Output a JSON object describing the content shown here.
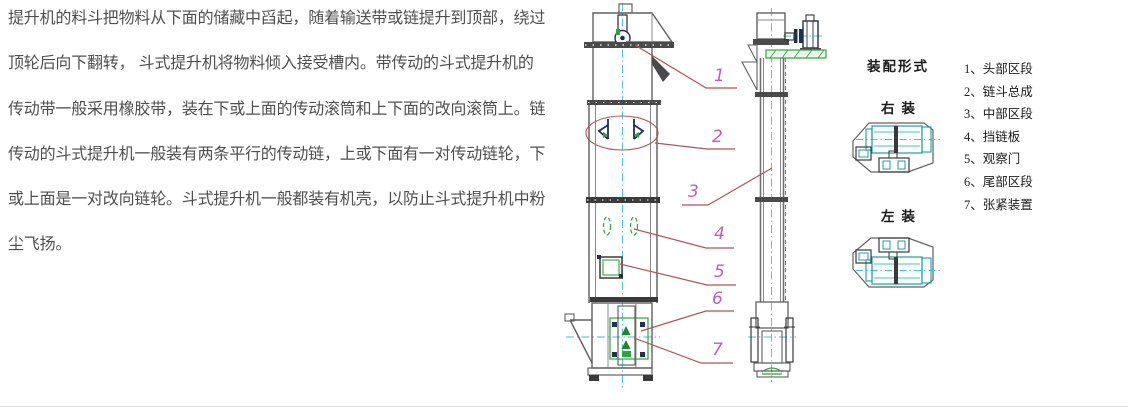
{
  "description": {
    "lines": [
      "提升机的料斗把物料从下面的储藏中舀起，随着输送带或链提升到顶部，绕过",
      "顶轮后向下翻转， 斗式提升机将物料倾入接受槽内。带传动的斗式提升机的",
      "传动带一般采用橡胶带，装在下或上面的传动滚筒和上下面的改向滚筒上。链",
      "传动的斗式提升机一般装有两条平行的传动链，上或下面有一对传动链轮，下",
      "或上面是一对改向链轮。斗式提升机一般都装有机壳，以防止斗式提升机中粉",
      "尘飞扬。"
    ]
  },
  "diagram": {
    "callouts": [
      "1",
      "2",
      "3",
      "4",
      "5",
      "6",
      "7"
    ],
    "assembly": {
      "title": "装配形式",
      "right_label": "右装",
      "left_label": "左装"
    },
    "legend": {
      "items": [
        "1、头部区段",
        "2、链斗总成",
        "3、中部区段",
        "4、挡链板",
        "5、观察门",
        "6、尾部区段",
        "7、张紧装置"
      ]
    },
    "colors": {
      "outline_gray": "#606060",
      "dark_detail": "#3a3a3a",
      "centerline_cyan": "#3ec6cc",
      "detail_green": "#2fa43c",
      "leader_red": "#b05555",
      "callout_magenta": "#c05fb0"
    }
  }
}
